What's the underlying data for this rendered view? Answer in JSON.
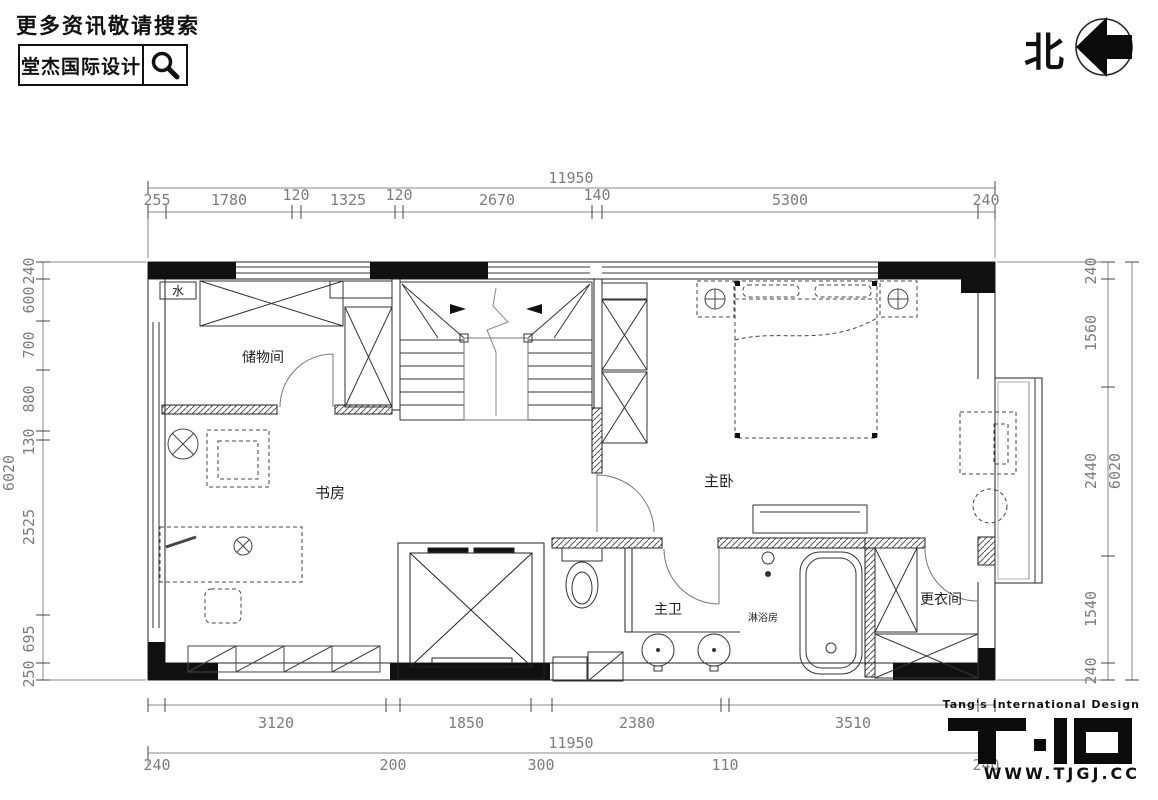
{
  "header": {
    "tagline": "更多资讯敬请搜索",
    "brand": "堂杰国际设计",
    "search_icon": "magnifier"
  },
  "compass": {
    "label": "北",
    "icon": "north-arrow-left"
  },
  "rooms": {
    "storage": "储物间",
    "study": "书房",
    "master_bedroom": "主卧",
    "master_bath": "主卫",
    "shower": "淋浴房",
    "dressing": "更衣间",
    "water": "水"
  },
  "dimensions": {
    "top": {
      "total": "11950",
      "segments": [
        "255",
        "1780",
        "120",
        "1325",
        "120",
        "2670",
        "140",
        "5300",
        "240"
      ]
    },
    "bottom": {
      "total": "11950",
      "segments": [
        "3120",
        "1850",
        "2380",
        "3510"
      ],
      "inner": [
        "240",
        "200",
        "300",
        "110",
        "240"
      ]
    },
    "left": {
      "total": "6020",
      "segments": [
        "240",
        "600",
        "700",
        "880",
        "130",
        "2525",
        "695",
        "250"
      ]
    },
    "right": {
      "total": "6020",
      "segments": [
        "240",
        "1560",
        "2440",
        "1540",
        "240"
      ]
    }
  },
  "footer": {
    "tagline": "Tang's International Design",
    "site": "WWW.TJGJ.CC"
  },
  "colors": {
    "ink": "#1a1a1a",
    "wall_fill": "#111111",
    "dim_line": "#8a8a8a",
    "dim_text": "#7c7c7c"
  }
}
